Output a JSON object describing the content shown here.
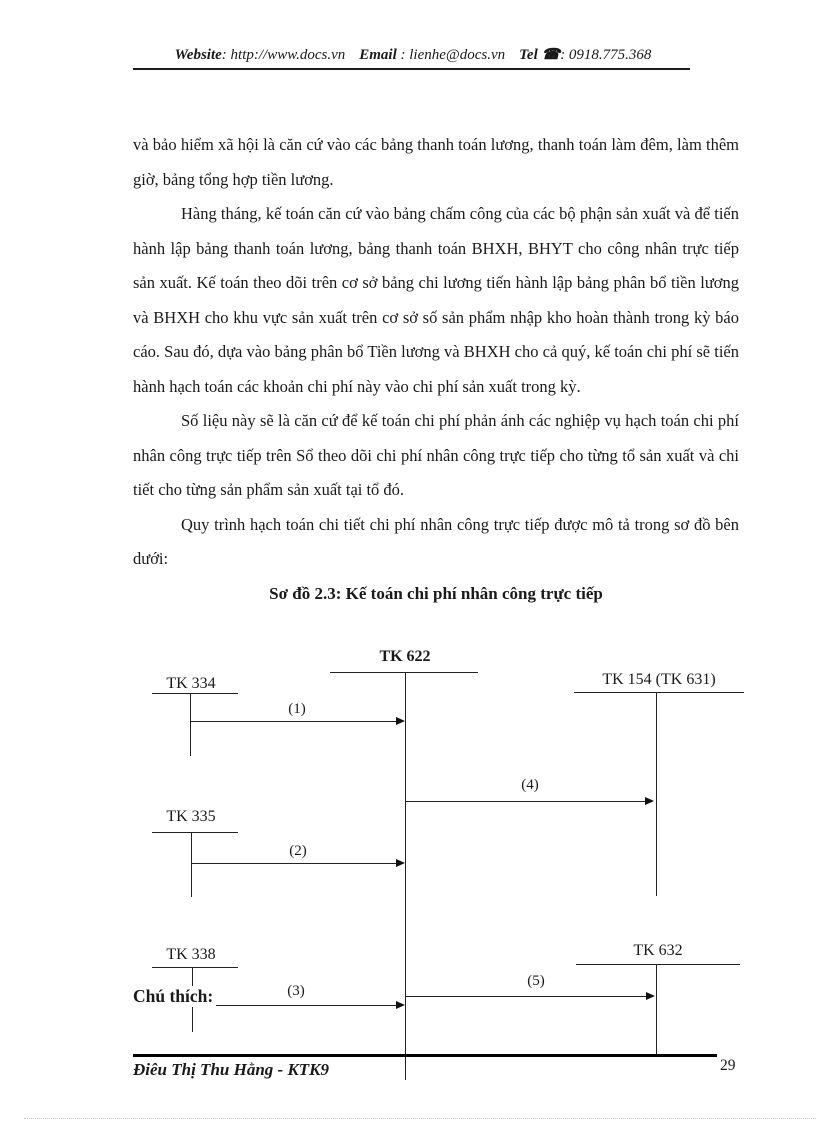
{
  "header": {
    "website_label": "Website",
    "website_value": ": http://www.docs.vn",
    "email_label": "Email",
    "email_value": ": lienhe@docs.vn",
    "tel_label": "Tel",
    "phone_icon": "☎",
    "tel_value": ": 0918.775.368"
  },
  "body": {
    "p1": "và bảo hiểm xã hội là căn cứ vào các bảng thanh toán lương, thanh toán làm đêm, làm thêm giờ, bảng tổng hợp tiền lương.",
    "p2": "Hàng tháng, kế toán căn cứ vào bảng chấm công của các bộ phận sản xuất và để tiến hành lập bảng thanh toán lương, bảng thanh toán BHXH, BHYT cho công nhân trực tiếp sản xuất. Kế toán theo dõi trên cơ sở bảng chi lương tiến hành lập bảng phân bổ tiền lương và BHXH cho khu vực sản xuất trên cơ sở số sản phẩm nhập kho hoàn thành trong kỳ báo cáo. Sau đó, dựa vào bảng phân bổ Tiền lương và BHXH cho cả quý, kế toán chi phí sẽ tiến hành hạch toán các khoản chi phí này vào chi phí sản xuất trong kỳ.",
    "p3": "Số liệu này sẽ là căn cứ để kế toán chi phí phản ánh các nghiệp vụ hạch toán chi phí nhân công trực tiếp trên Sổ theo dõi chi phí nhân công trực tiếp cho từng tổ sản xuất và chi tiết cho từng sản phẩm sản xuất tại tổ đó.",
    "p4": "Quy trình hạch toán chi tiết chi phí nhân công trực tiếp được mô tả trong sơ đồ bên dưới:",
    "diagram_title": "Sơ đồ 2.3: Kế toán chi phí nhân công trực tiếp"
  },
  "diagram": {
    "accounts": [
      {
        "id": "tk622",
        "label": "TK 622"
      },
      {
        "id": "tk334",
        "label": "TK 334"
      },
      {
        "id": "tk154",
        "label": "TK 154 (TK 631)"
      },
      {
        "id": "tk335",
        "label": "TK 335"
      },
      {
        "id": "tk338",
        "label": "TK 338"
      },
      {
        "id": "tk632",
        "label": "TK 632"
      }
    ],
    "arrows": [
      {
        "label": "(1)"
      },
      {
        "label": "(2)"
      },
      {
        "label": "(3)"
      },
      {
        "label": "(4)"
      },
      {
        "label": "(5)"
      }
    ],
    "legend_label": "Chú thích:"
  },
  "footer": {
    "author": "Điêu Thị Thu Hằng - KTK9",
    "page_number": "29"
  }
}
